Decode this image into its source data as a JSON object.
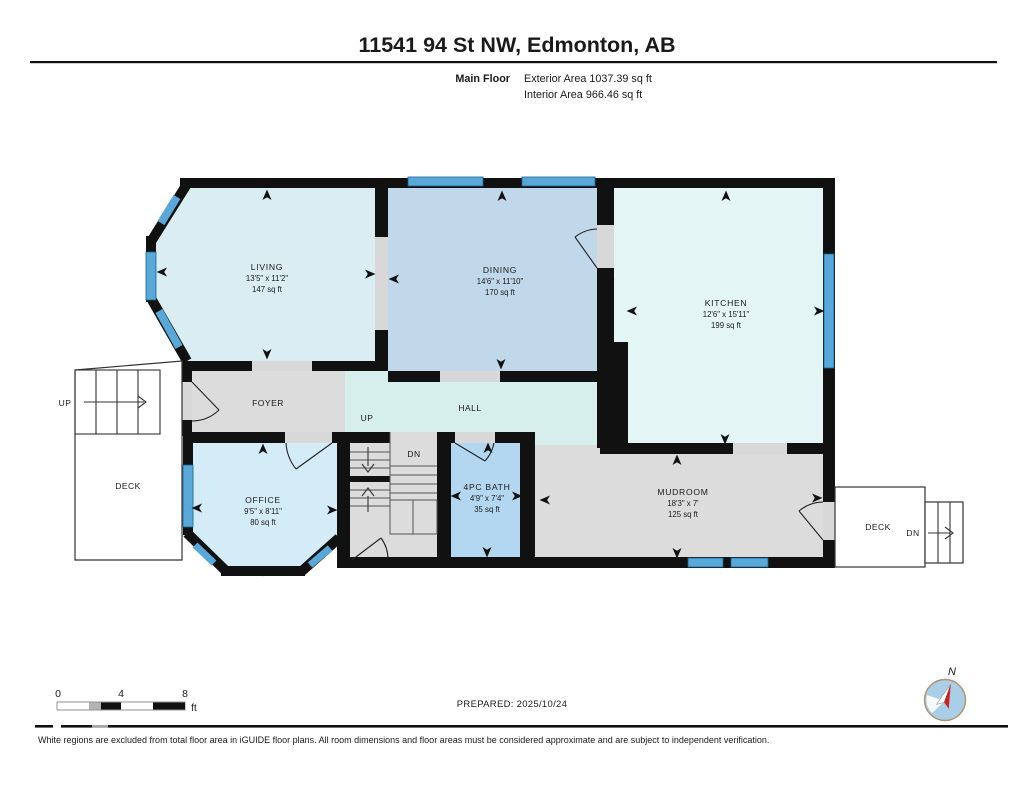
{
  "header": {
    "title": "11541 94 St NW, Edmonton, AB",
    "floor_label": "Main Floor",
    "exterior_area": "Exterior Area 1037.39 sq ft",
    "interior_area": "Interior Area 966.46 sq ft"
  },
  "rooms": {
    "living": {
      "name": "LIVING",
      "dims": "13'5\" x 11'2\"",
      "area": "147 sq ft"
    },
    "dining": {
      "name": "DINING",
      "dims": "14'6\" x 11'10\"",
      "area": "170 sq ft"
    },
    "kitchen": {
      "name": "KITCHEN",
      "dims": "12'6\" x 15'11\"",
      "area": "199 sq ft"
    },
    "foyer": {
      "name": "FOYER"
    },
    "hall": {
      "name": "HALL"
    },
    "office": {
      "name": "OFFICE",
      "dims": "9'5\" x 8'11\"",
      "area": "80 sq ft"
    },
    "bath": {
      "name": "4PC BATH",
      "dims": "4'9\" x 7'4\"",
      "area": "35 sq ft"
    },
    "mudroom": {
      "name": "MUDROOM",
      "dims": "18'3\" x 7'",
      "area": "125 sq ft"
    },
    "deck_left": {
      "name": "DECK"
    },
    "deck_right": {
      "name": "DECK"
    }
  },
  "stairs": {
    "left_up": "UP",
    "hall_up": "UP",
    "center_dn": "DN",
    "deck_dn": "DN"
  },
  "scale_bar": {
    "tick_0": "0",
    "tick_4": "4",
    "tick_8": "8",
    "unit": "ft"
  },
  "compass": {
    "north_label": "N"
  },
  "footer": {
    "prepared": "PREPARED: 2025/10/24",
    "disclaimer": "White regions are excluded from total floor area in iGUIDE floor plans. All room dimensions and floor areas must be considered approximate and are subject to independent verification."
  },
  "colors": {
    "wall": "#111111",
    "living": "#d9edf3",
    "dining": "#c1d7ea",
    "kitchen": "#e4f5f6",
    "hall": "#d7efec",
    "office": "#d4ebf8",
    "bath": "#b3d7f0",
    "gray_room": "#dcdcdc",
    "opening": "#d8d8d8",
    "window": "#58a9d9",
    "window_edge": "#1d5f8e",
    "deck_fill": "#ffffff",
    "outline": "#333333",
    "compass_fill": "#a9cfe8",
    "compass_ring": "#b5916b",
    "needle_red": "#cc2222",
    "text": "#1a1a1a"
  }
}
